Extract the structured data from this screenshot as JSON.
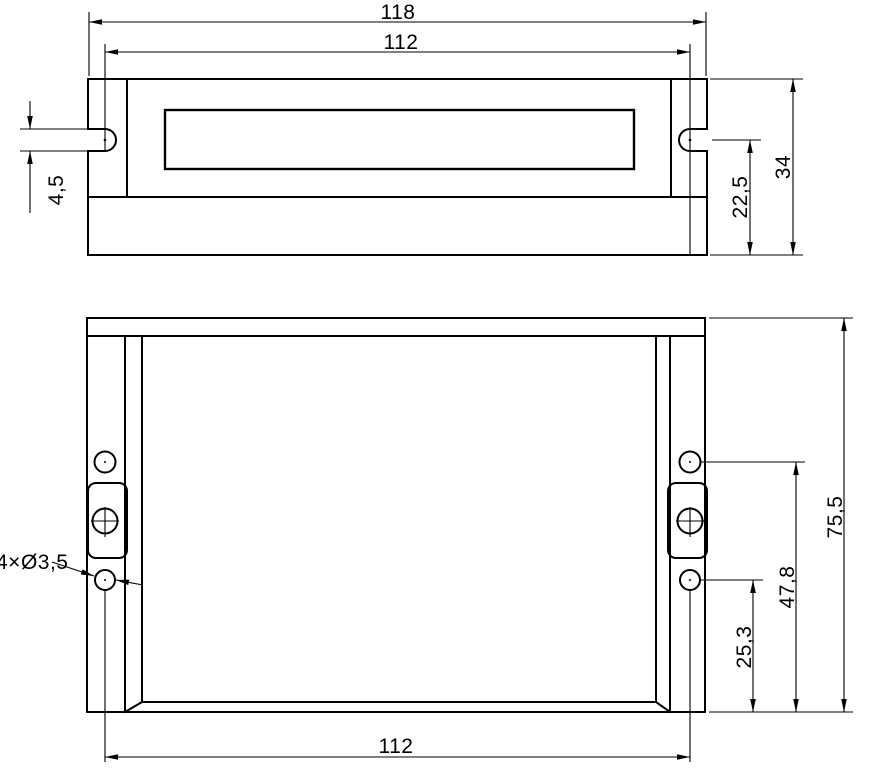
{
  "drawing": {
    "type": "mechanical-outline-two-views",
    "views": {
      "front_view": {
        "name": "front-view",
        "dims": {
          "overall_width": "118",
          "slot_center_span": "112",
          "slot_width": "4,5",
          "slot_center_to_bottom": "22,5",
          "overall_height": "34"
        }
      },
      "plan_view": {
        "name": "plan-view",
        "dims": {
          "overall_depth": "75,5",
          "upper_hole_from_bottom": "47,8",
          "lower_hole_from_bottom": "25,3",
          "hole_center_span": "112",
          "hole_callout": "4×Ø3,5"
        }
      }
    },
    "colors": {
      "line": "#000000",
      "background": "#ffffff"
    }
  }
}
